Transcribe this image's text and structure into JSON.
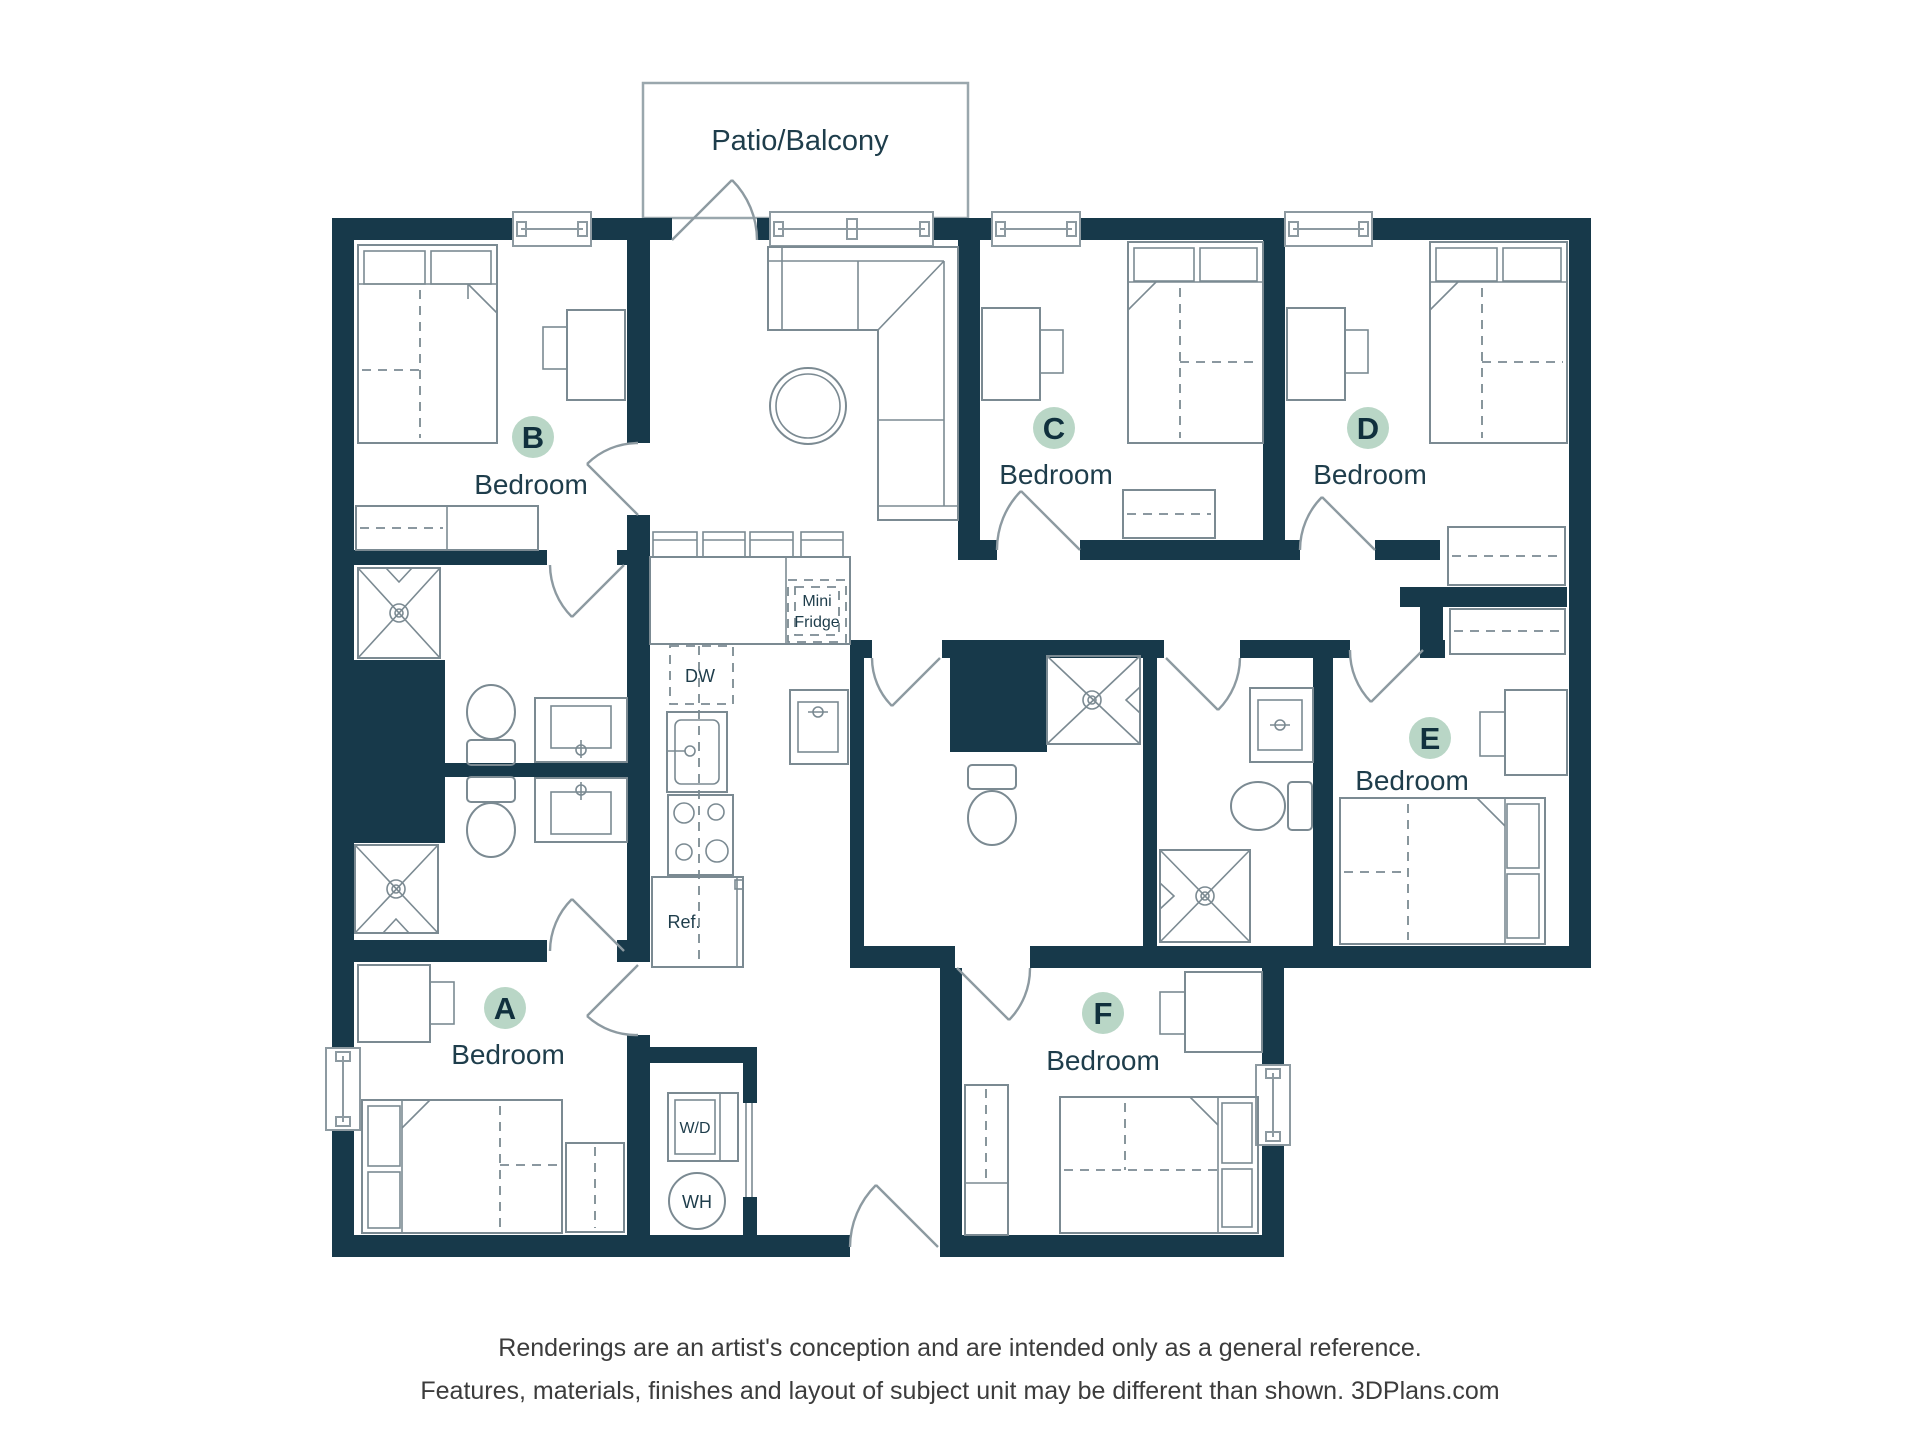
{
  "patio": {
    "label": "Patio/Balcony"
  },
  "rooms": [
    {
      "id": "A",
      "letter": "A",
      "label": "Bedroom"
    },
    {
      "id": "B",
      "letter": "B",
      "label": "Bedroom"
    },
    {
      "id": "C",
      "letter": "C",
      "label": "Bedroom"
    },
    {
      "id": "D",
      "letter": "D",
      "label": "Bedroom"
    },
    {
      "id": "E",
      "letter": "E",
      "label": "Bedroom"
    },
    {
      "id": "F",
      "letter": "F",
      "label": "Bedroom"
    }
  ],
  "kitchen": {
    "mini_fridge_line1": "Mini",
    "mini_fridge_line2": "Fridge",
    "dishwasher": "DW",
    "refrigerator": "Ref.",
    "washer_dryer": "W/D",
    "water_heater": "WH"
  },
  "disclaimer": {
    "line1": "Renderings are an artist's conception and are intended only as a general reference.",
    "line2": "Features, materials, finishes and layout of subject unit may be different than shown. 3DPlans.com"
  },
  "colors": {
    "wall": "#17394a",
    "badge": "#b9d6c6",
    "badge_text": "#10303d",
    "furniture": "#7b8a92",
    "label": "#1e3d4b",
    "disclaimer": "#3c3c3c",
    "window": "#8d9aa1"
  }
}
